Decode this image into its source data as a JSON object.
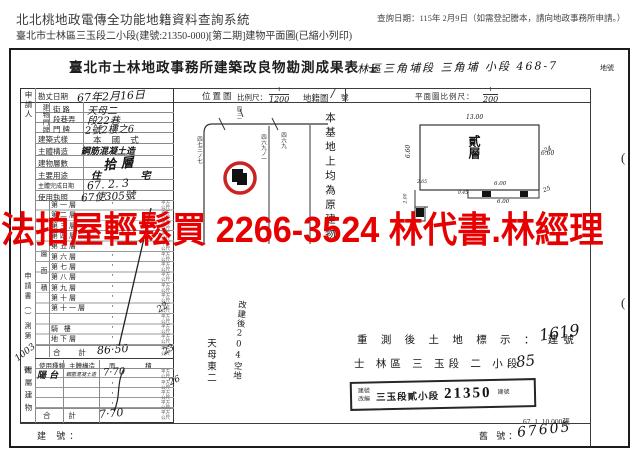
{
  "app_header": {
    "system_title": "北北桃地政電傳全功能地籍資料查詢系統",
    "query_date": "查詢日期：115年 2月9日（如需登記謄本，請向地政事務所申請。）",
    "subtitle": "臺北市士林區三玉段二小段(建號:21350-000)[第二期]建物平面圖(已縮小列印)"
  },
  "overlay": {
    "ad_text": "法拍屋輕鬆買 2266-3524 林代書.林經理",
    "color": "#e60000"
  },
  "form": {
    "title": "臺北市士林地政事務所建築改良物勘測成果表",
    "title_suffix": "士",
    "section_handwritten": "林區三角埔段 三角埔 小段 468-7",
    "land_no_label": "地號",
    "applicant_label": "申請人",
    "info": {
      "survey_date_label": "勘丈日期",
      "survey_date_value": "67年2月16日",
      "address_side_label": "建物門牌",
      "address_rows": [
        {
          "label": "街 路",
          "value": "天母二"
        },
        {
          "label": "段巷弄",
          "value": "段22巷"
        },
        {
          "label": "門 牌",
          "value": "2號2樓之6"
        }
      ],
      "style_label": "建築式樣",
      "style_value": "本 國 式",
      "structure_label": "主體構造",
      "structure_value": "鋼筋混凝土造",
      "floors_label": "建物層數",
      "floors_value": "拾 層",
      "use_label": "主要用途",
      "use_value": "住 宅",
      "complete_label": "主體完成日期",
      "complete_value": "67. 2. 3",
      "license_label": "使用執照",
      "license_value": "67使305號"
    },
    "area_table": {
      "side_label": "層面積",
      "unit_stamp": "平方公尺",
      "dot": "·",
      "rows": [
        "第一層",
        "第二層",
        "第三層",
        "第四層",
        "第五層",
        "第六層",
        "第七層",
        "第八層",
        "第九層",
        "第十層",
        "第十一層",
        "",
        "騎 樓",
        "地下層"
      ],
      "total_label": "合 計",
      "total_value": "86·50"
    },
    "application_no_vertical": "申請書（）測第",
    "application_no_value": "1003",
    "application_no_suffix": "號",
    "annex": {
      "side_label": "附屬建物",
      "header": {
        "use": "使用種類",
        "structure": "主體構造",
        "area": "面 積"
      },
      "row": {
        "use": "陽 台",
        "structure": "鋼筋混凝土造",
        "value": "7·70"
      },
      "total_label": "合 計",
      "total_value": "7·70"
    },
    "building_no_label": "建 號：",
    "old_no_label": "舊 號：",
    "old_no_value": "67605",
    "location_map": {
      "title": "位置圖",
      "scale_label": "比例尺：",
      "scale_num": "1",
      "scale_den": "1200",
      "cadastral_label": "地籍圖",
      "cadastral_value": "∕",
      "cadastral_suffix": "號",
      "lot_label_top": "四三一",
      "lot_label_left": "四七三ノ七",
      "lot_label_mid": "四六九ノ一",
      "lot_label_right": "四六九",
      "note_vertical": "本基地上均為原建物"
    },
    "floor_plan": {
      "scale_label": "平面圖比例尺：",
      "scale_num": "1",
      "scale_den": "200",
      "room_label": "貳層",
      "dim_top": "13.00",
      "dim_left": "6.60",
      "dim_right": "6.60",
      "dim_bottom_above": "6.00",
      "dim_bottom_below": "6.00",
      "dim_small_left": "2.65",
      "dim_small_left_v": "2.00",
      "dim_small_a": "0.45"
    },
    "resurvey_line1": "重 測 後 土 地 標 示 ： 建號",
    "resurvey_line1_hand": "1619",
    "resurvey_line2": "士 林區 三 玉段  二 小段",
    "resurvey_line2_hand": "85",
    "stamp": {
      "prefix": "建號改編",
      "section": "三玉段貳小段",
      "number": "21350",
      "suffix": "建號"
    },
    "print_info": "67. 1. 10,000張",
    "margin_marks": {
      "paren": "(",
      "m1": "24",
      "m2": "25"
    },
    "notes": {
      "n1": "22",
      "n2": "23",
      "n3": "26",
      "v1": "天母東二",
      "v2": "改建後204空地"
    }
  }
}
